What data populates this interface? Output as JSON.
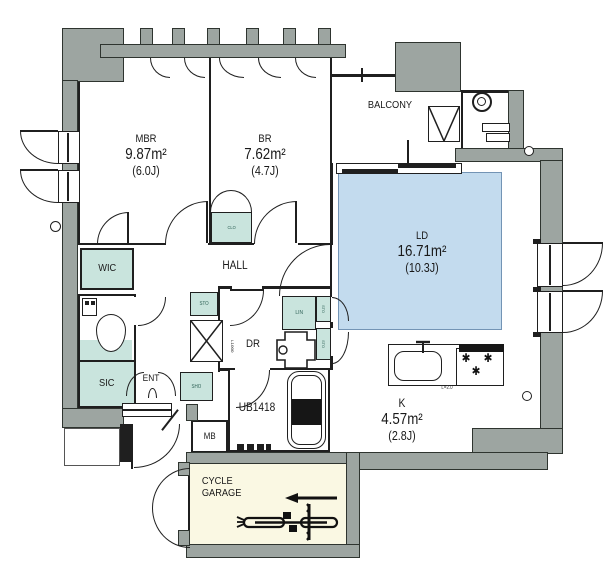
{
  "colors": {
    "wall_gray": "#9DA5A1",
    "closet_teal": "#C9E4DD",
    "ld_blue": "#C3DBEE",
    "garage_cream": "#FAF8E3",
    "line_black": "#1f1f1f"
  },
  "labels": {
    "mbr": {
      "name": "MBR",
      "area": "9.87m²",
      "jo": "(6.0J)"
    },
    "br": {
      "name": "BR",
      "area": "7.62m²",
      "jo": "(4.7J)"
    },
    "ld": {
      "name": "LD",
      "area": "16.71m²",
      "jo": "(10.3J)"
    },
    "k": {
      "name": "K",
      "area": "4.57m²",
      "jo": "(2.8J)"
    },
    "balcony": "BALCONY",
    "hall": "HALL",
    "dr": "DR",
    "ent": "ENT",
    "wic": "WIC",
    "sic": "SIC",
    "ub": "UB1418",
    "mb": "MB",
    "garage1": "CYCLE",
    "garage2": "GARAGE",
    "clo": "CLO",
    "lin": "LIN",
    "sto_hall": "STO",
    "sto_upper": "STO",
    "sto_lower": "STO",
    "sho": "SHO",
    "washer": "L1000",
    "counter": "L=2.0"
  },
  "icons": {
    "burner": "✱"
  }
}
